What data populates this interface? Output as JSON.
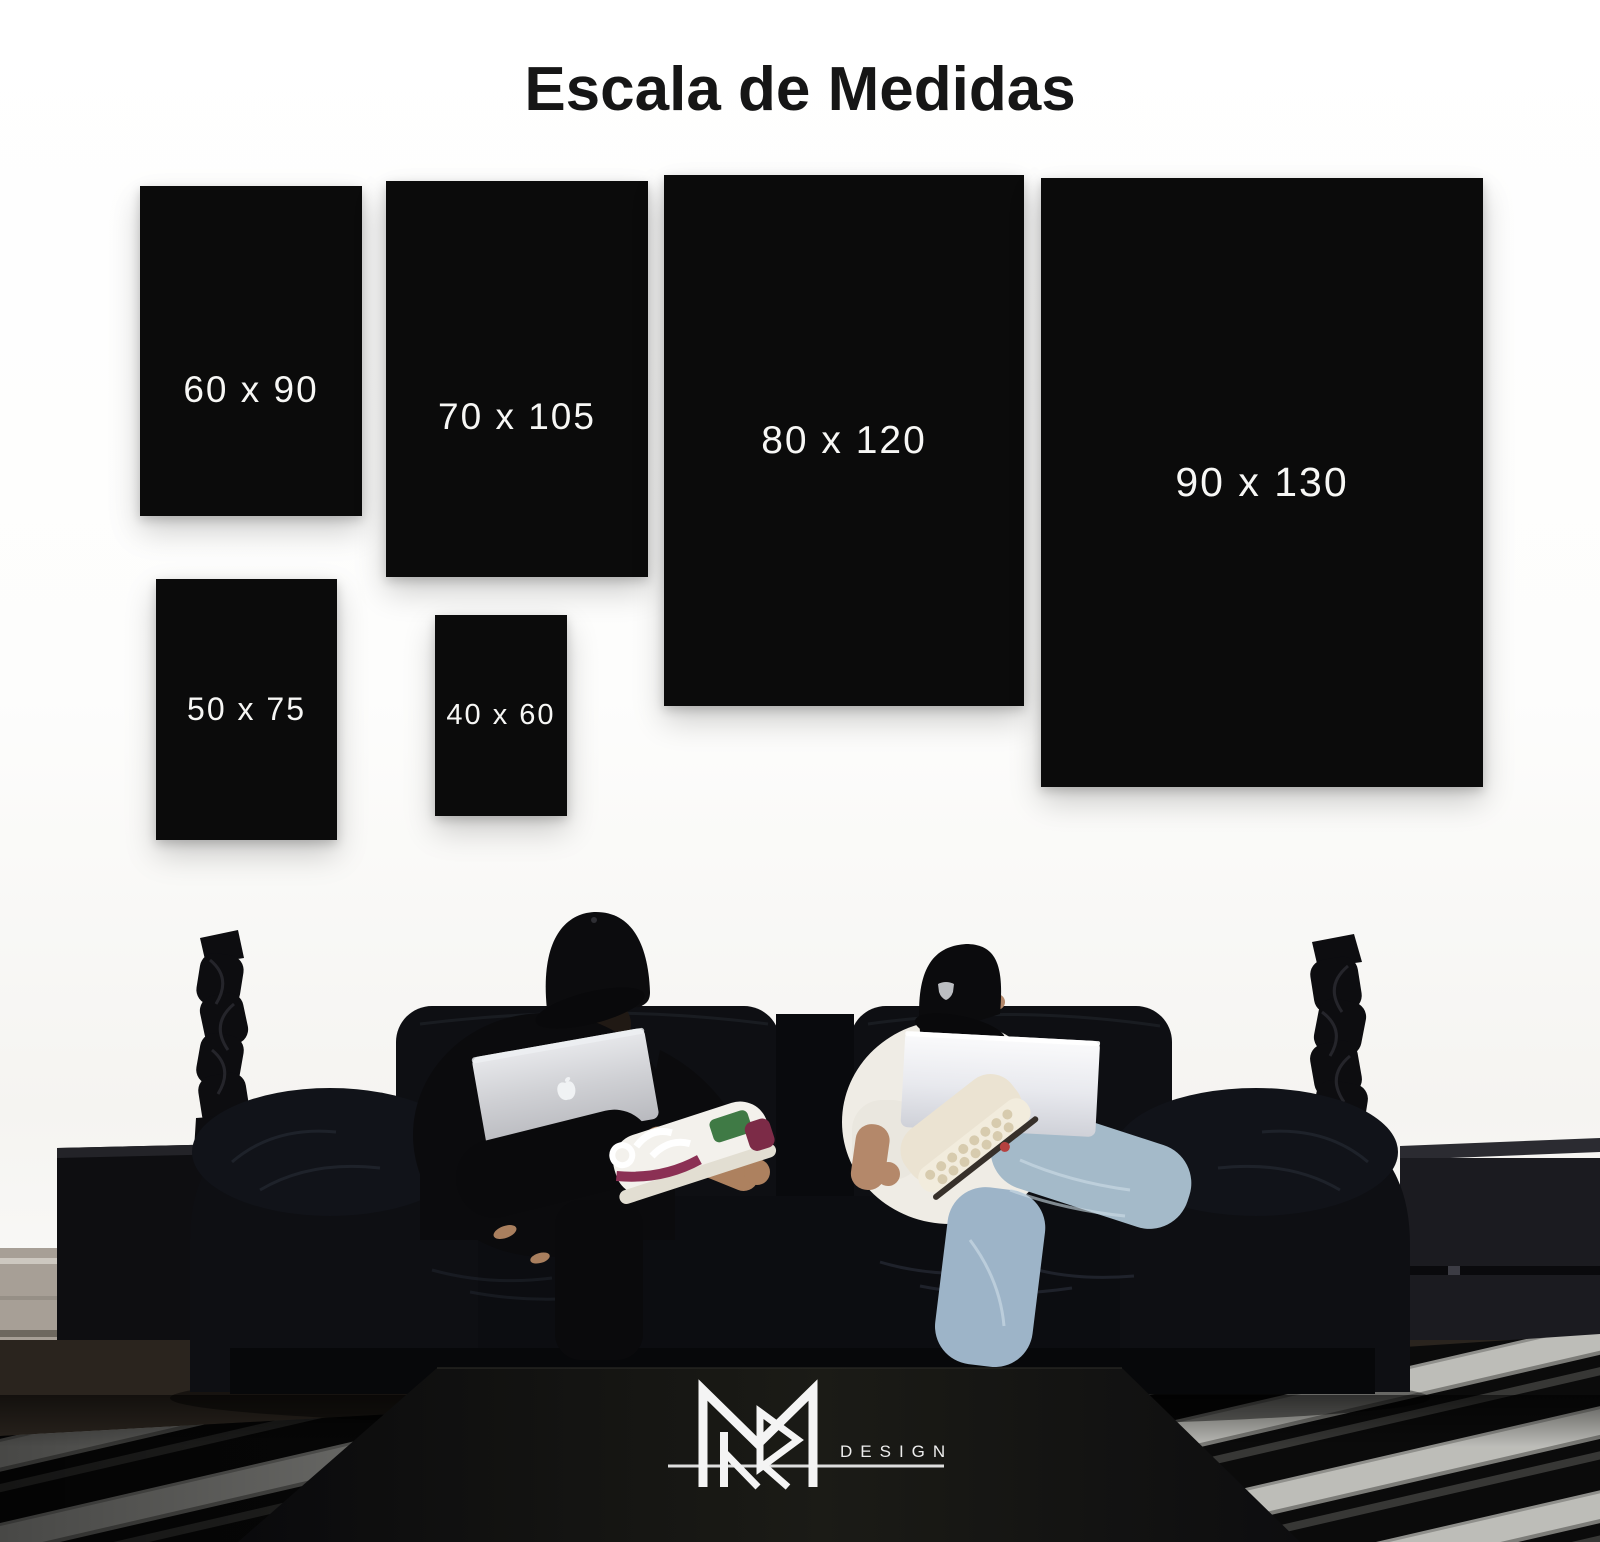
{
  "title": "Escala de Medidas",
  "sizes": {
    "items": [
      {
        "label": "60 x 90"
      },
      {
        "label": "70 x 105"
      },
      {
        "label": "80 x 120"
      },
      {
        "label": "90 x 130"
      },
      {
        "label": "50 x 75"
      },
      {
        "label": "40 x 60"
      }
    ]
  },
  "logo": {
    "monogram_icon": "mr-monogram-icon",
    "design_label": "DESIGN"
  },
  "colors": {
    "panel_black": "#0b0b0b",
    "label_white": "#f7f7f5",
    "wall_white": "#fdfdfc",
    "sofa_black": "#0e0f13",
    "denim_blue": "#a4bac9",
    "rug_stripe": "#bdbdb8",
    "logo_white": "#f2f2f2"
  }
}
